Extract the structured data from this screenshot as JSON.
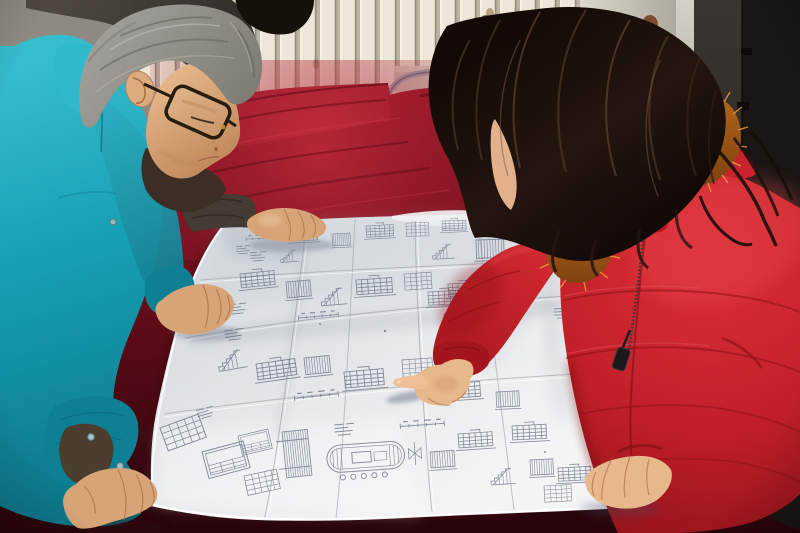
{
  "meta": {
    "alt": "Photograph: an older engineer in a teal work jacket and glasses and a woman in a red fur-trimmed parka lean over a large folded construction blueprint spread on a dark red velvet-covered table; the woman points at a detail while a third colleague's hand rests on the sheet; a cream radiator, whitish wall panel and a dark door form the background.",
    "width": 800,
    "height": 533
  },
  "palette": {
    "wall": "#8f8a81",
    "radiator": "#ece7d8",
    "radiator_gap": "#b8b2a2",
    "panel": "#ddd8cb",
    "door": "#1a1613",
    "door_panel": "#332e2a",
    "door_frame": "#d5d1c7",
    "rust": "#7a431c",
    "chair_metal": "#9aa8b5",
    "chair_seat": "#9c1620",
    "velvet": "#7a1120",
    "velvet_deep": "#27040a",
    "velvet_glow": "#c93040",
    "paper": "#e8eaec",
    "ink": "#6f7a8c",
    "teal": "#17a0b4",
    "teal_deep": "#0e8093",
    "teal_light": "#35bccd",
    "skin": "#d7a477",
    "skin_light": "#e8b88d",
    "skin_shadow": "#a9724a",
    "hair_gray": "#a3a19b",
    "hair_dark": "#16100b",
    "coat_red": "#c8232c",
    "coat_deep": "#a3151d",
    "coat_light": "#e84b52",
    "fur": "#b5651a",
    "fur_light": "#e89c3e",
    "jacket_dark": "#433b34"
  },
  "blueprint": {
    "motifs": [
      {
        "t": "dim",
        "x": 246,
        "y": 236,
        "s": 0.8,
        "r": -3
      },
      {
        "t": "elev",
        "x": 290,
        "y": 230,
        "s": 0.8,
        "r": -3
      },
      {
        "t": "cols",
        "x": 332,
        "y": 234,
        "s": 0.75,
        "r": -3
      },
      {
        "t": "elev",
        "x": 366,
        "y": 226,
        "s": 0.8,
        "r": -3
      },
      {
        "t": "table",
        "x": 406,
        "y": 223,
        "s": 0.75,
        "r": -2
      },
      {
        "t": "elev",
        "x": 442,
        "y": 221,
        "s": 0.7,
        "r": -2
      },
      {
        "t": "cols",
        "x": 478,
        "y": 223,
        "s": 0.7,
        "r": -2
      },
      {
        "t": "text",
        "x": 250,
        "y": 252,
        "s": 0.8,
        "r": -4
      },
      {
        "t": "stair",
        "x": 280,
        "y": 250,
        "s": 0.7,
        "r": -4
      },
      {
        "t": "text",
        "x": 236,
        "y": 246,
        "s": 0.7,
        "r": -5
      },
      {
        "t": "dim",
        "x": 508,
        "y": 250,
        "s": 0.85,
        "r": -3
      },
      {
        "t": "elev",
        "x": 240,
        "y": 274,
        "s": 1.0,
        "r": -6
      },
      {
        "t": "cols",
        "x": 286,
        "y": 282,
        "s": 1.0,
        "r": -5
      },
      {
        "t": "stair",
        "x": 320,
        "y": 288,
        "s": 1.0,
        "r": -5
      },
      {
        "t": "elev",
        "x": 356,
        "y": 280,
        "s": 1.05,
        "r": -4
      },
      {
        "t": "dim",
        "x": 298,
        "y": 314,
        "s": 1.0,
        "r": -5
      },
      {
        "t": "table",
        "x": 404,
        "y": 274,
        "s": 0.9,
        "r": -4
      },
      {
        "t": "elev",
        "x": 448,
        "y": 284,
        "s": 0.9,
        "r": -3
      },
      {
        "t": "text",
        "x": 228,
        "y": 304,
        "s": 0.9,
        "r": -6
      },
      {
        "t": "cols",
        "x": 444,
        "y": 314,
        "s": 0.9,
        "r": -3
      },
      {
        "t": "stair",
        "x": 432,
        "y": 244,
        "s": 0.85,
        "r": -3
      },
      {
        "t": "cols",
        "x": 476,
        "y": 240,
        "s": 1.15,
        "r": -2
      },
      {
        "t": "elev",
        "x": 428,
        "y": 292,
        "s": 0.95,
        "r": -3
      },
      {
        "t": "stair",
        "x": 216,
        "y": 352,
        "s": 1.1,
        "r": -10
      },
      {
        "t": "elev",
        "x": 256,
        "y": 364,
        "s": 1.15,
        "r": -8
      },
      {
        "t": "cols",
        "x": 304,
        "y": 358,
        "s": 1.05,
        "r": -6
      },
      {
        "t": "elev",
        "x": 344,
        "y": 372,
        "s": 1.15,
        "r": -5
      },
      {
        "t": "dim",
        "x": 294,
        "y": 394,
        "s": 1.1,
        "r": -6
      },
      {
        "t": "table",
        "x": 402,
        "y": 360,
        "s": 1.0,
        "r": -4
      },
      {
        "t": "elev",
        "x": 444,
        "y": 384,
        "s": 1.05,
        "r": -4
      },
      {
        "t": "text",
        "x": 224,
        "y": 330,
        "s": 0.95,
        "r": -8
      },
      {
        "t": "cols",
        "x": 496,
        "y": 392,
        "s": 0.95,
        "r": -3
      },
      {
        "t": "elev",
        "x": 512,
        "y": 426,
        "s": 1.0,
        "r": -3
      },
      {
        "t": "cols",
        "x": 530,
        "y": 460,
        "s": 0.95,
        "r": -3
      },
      {
        "t": "text",
        "x": 554,
        "y": 308,
        "s": 0.9,
        "r": -3
      },
      {
        "t": "cols",
        "x": 570,
        "y": 330,
        "s": 0.9,
        "r": -3
      },
      {
        "t": "table",
        "x": 160,
        "y": 428,
        "s": 1.35,
        "r": -20
      },
      {
        "t": "frame",
        "x": 202,
        "y": 452,
        "s": 1.25,
        "r": -15
      },
      {
        "t": "table",
        "x": 244,
        "y": 476,
        "s": 1.1,
        "r": -12
      },
      {
        "t": "hatch",
        "x": 282,
        "y": 432,
        "s": 1.15,
        "r": -6
      },
      {
        "t": "stadium",
        "x": 326,
        "y": 446,
        "s": 1.05,
        "r": -4
      },
      {
        "t": "text",
        "x": 334,
        "y": 424,
        "s": 1.0,
        "r": -5
      },
      {
        "t": "dim",
        "x": 400,
        "y": 422,
        "s": 1.1,
        "r": -4
      },
      {
        "t": "cols",
        "x": 430,
        "y": 452,
        "s": 1.0,
        "r": -4
      },
      {
        "t": "elev",
        "x": 458,
        "y": 434,
        "s": 1.0,
        "r": -4
      },
      {
        "t": "stair",
        "x": 490,
        "y": 468,
        "s": 0.95,
        "r": -4
      },
      {
        "t": "elev",
        "x": 558,
        "y": 468,
        "s": 0.95,
        "r": -3
      },
      {
        "t": "table",
        "x": 544,
        "y": 486,
        "s": 0.9,
        "r": -3
      },
      {
        "t": "text",
        "x": 196,
        "y": 410,
        "s": 0.85,
        "r": -16
      },
      {
        "t": "frame",
        "x": 238,
        "y": 436,
        "s": 0.9,
        "r": -13
      }
    ]
  }
}
